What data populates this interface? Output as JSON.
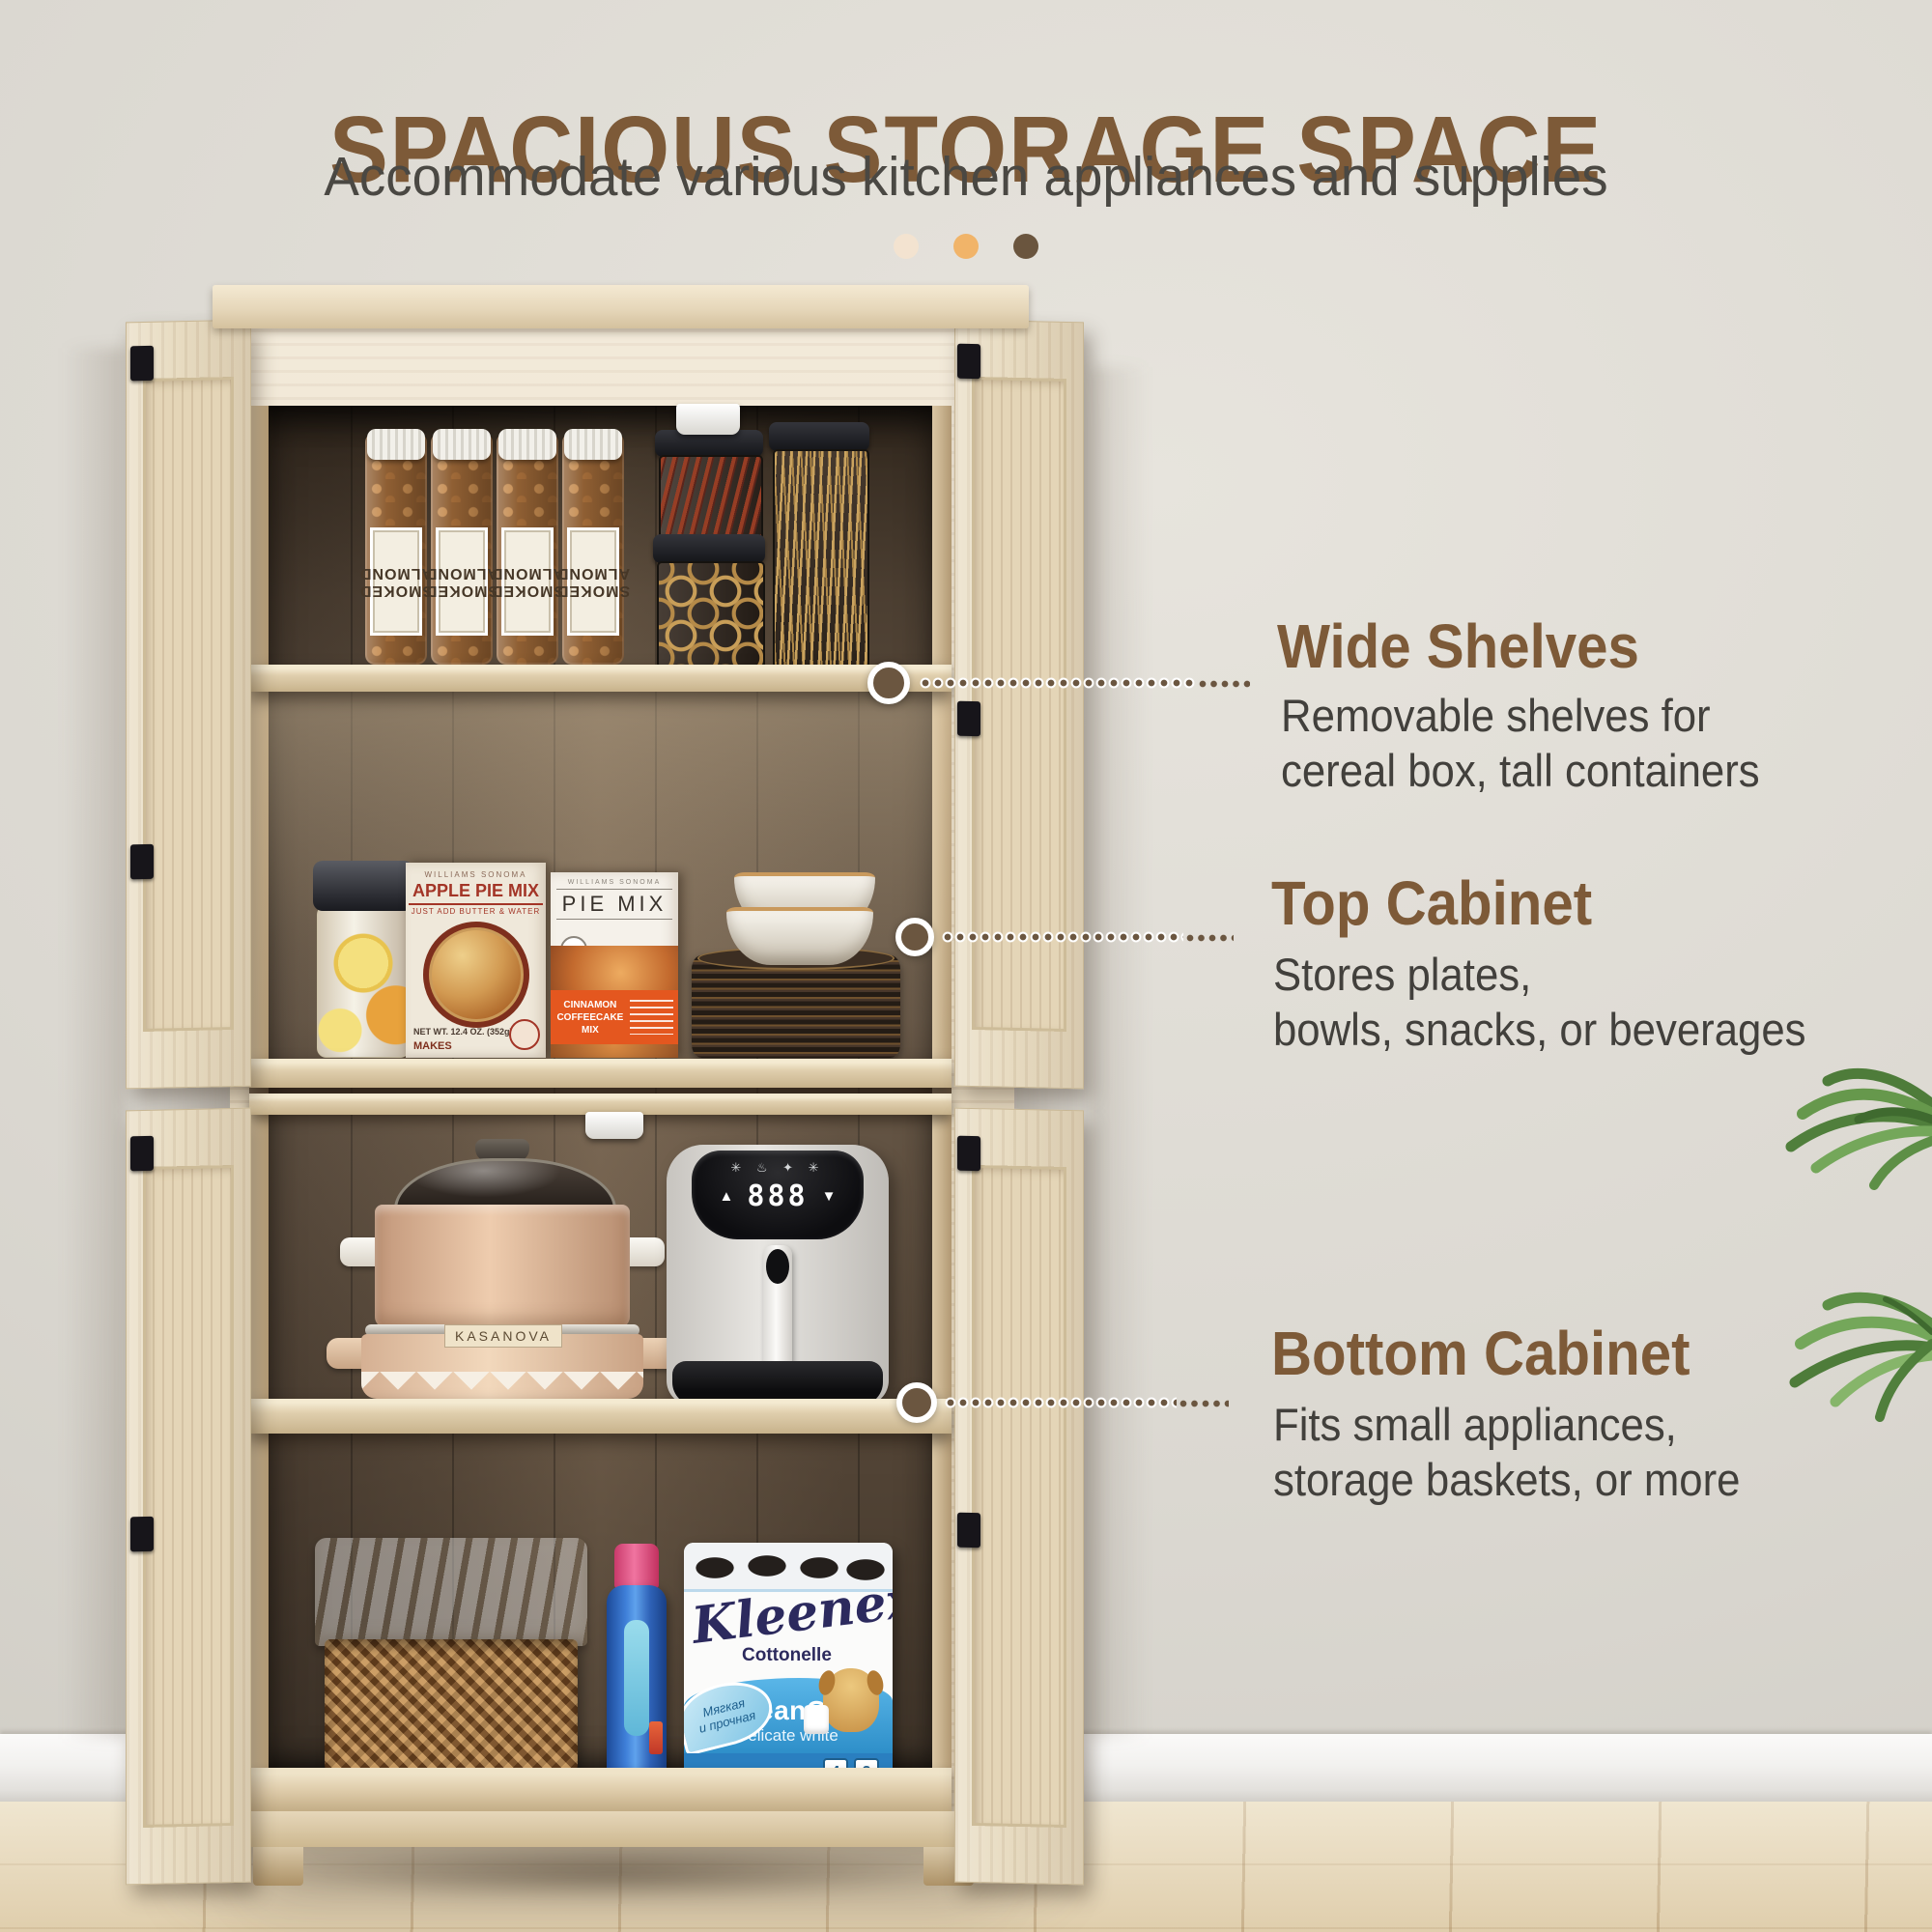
{
  "page": {
    "title": "SPACIOUS STORAGE SPACE",
    "subtitle": "Accommodate various kitchen appliances and supplies"
  },
  "accent_dots": {
    "colors": [
      "#f3e3d0",
      "#f1b469",
      "#6a553e"
    ]
  },
  "callouts": [
    {
      "title": "Wide Shelves",
      "line1": "Removable shelves for",
      "line2": "cereal box, tall containers"
    },
    {
      "title": "Top Cabinet",
      "line1": "Stores plates,",
      "line2": "bowls, snacks, or beverages"
    },
    {
      "title": "Bottom Cabinet",
      "line1": "Fits small appliances,",
      "line2": "storage baskets, or more"
    }
  ],
  "products": {
    "almond_jar": {
      "line1": "SMOKED",
      "line2": "ALMOND"
    },
    "apple_box": {
      "brand": "WILLIAMS SONOMA",
      "name": "APPLE PIE MIX",
      "tagline": "JUST ADD BUTTER & WATER",
      "net_wt": "NET WT. 12.4 OZ. (352g)",
      "makes": "MAKES"
    },
    "pie_box": {
      "brand": "WILLIAMS SONOMA",
      "name": "PIE MIX",
      "flavor_line1": "CINNAMON",
      "flavor_line2": "COFFEECAKE MIX"
    },
    "pot": {
      "brand": "KASANOVA"
    },
    "air_fryer": {
      "icons": "✳ ♨ ✦ ✳",
      "display": "888",
      "up_arrow": "▲",
      "down_arrow": "▼"
    },
    "kleenex": {
      "brand": "Kleenex",
      "sub_brand": "Cottonelle",
      "product": "CleanCare",
      "variant": "Delicate white",
      "badge_left_line1": "Мягкая",
      "badge_left_line2": "и прочная",
      "rolls_count": "4",
      "ply_count": "2"
    }
  },
  "colors": {
    "accent_brown": "#7d5a38",
    "body_text": "#42403c",
    "leader_dot": "#6b5640",
    "wall": "#dad7d0",
    "floor": "#e8dabb"
  }
}
